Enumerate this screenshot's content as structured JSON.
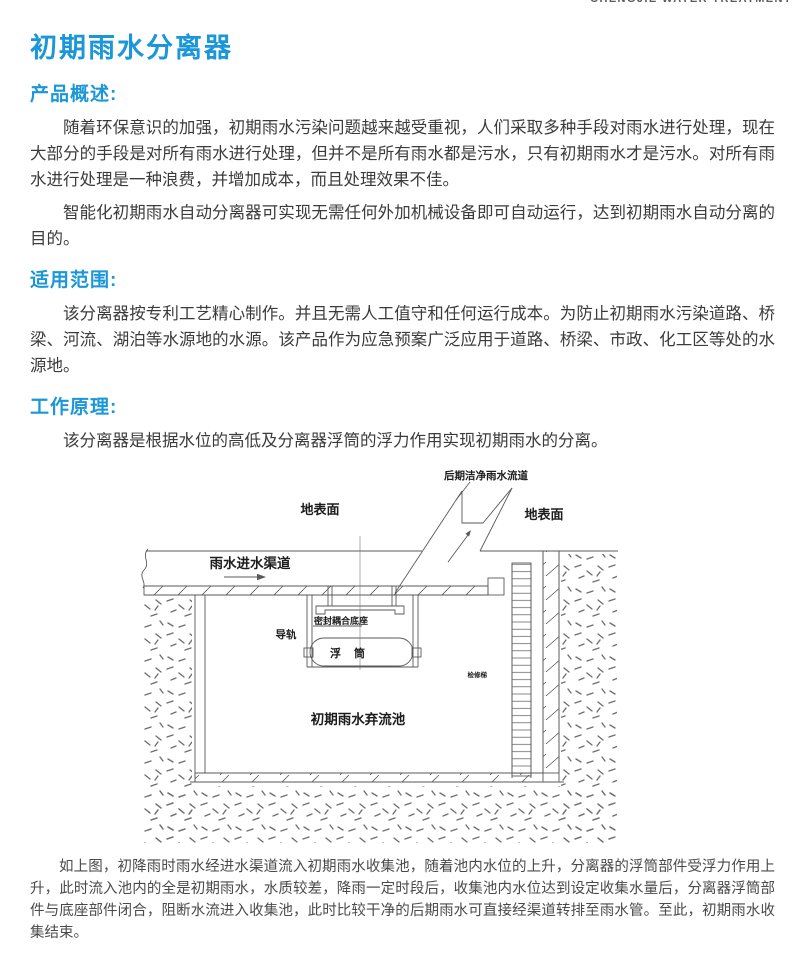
{
  "header": {
    "brand_text": "CHENGJIE WATER TREATMENT"
  },
  "page": {
    "title": "初期雨水分离器"
  },
  "sections": {
    "overview": {
      "heading": "产品概述:",
      "paragraphs": [
        "随着环保意识的加强，初期雨水污染问题越来越受重视，人们采取多种手段对雨水进行处理，现在大部分的手段是对所有雨水进行处理，但并不是所有雨水都是污水，只有初期雨水才是污水。对所有雨水进行处理是一种浪费，并增加成本，而且处理效果不佳。",
        "智能化初期雨水自动分离器可实现无需任何外加机械设备即可自动运行，达到初期雨水自动分离的目的。"
      ]
    },
    "scope": {
      "heading": "适用范围:",
      "paragraphs": [
        "该分离器按专利工艺精心制作。并且无需人工值守和任何运行成本。为防止初期雨水污染道路、桥梁、河流、湖泊等水源地的水源。该产品作为应急预案广泛应用于道路、桥梁、市政、化工区等处的水源地。"
      ]
    },
    "principle": {
      "heading": "工作原理:",
      "paragraphs": [
        "该分离器是根据水位的高低及分离器浮筒的浮力作用实现初期雨水的分离。"
      ]
    }
  },
  "diagram": {
    "labels": {
      "clean_outlet": "后期洁净雨水流道",
      "ground_left": "地表面",
      "ground_right": "地表面",
      "inlet_channel": "雨水进水渠道",
      "seal_base": "密封耦合底座",
      "guide_rail": "导轨",
      "float_drum": "浮筒",
      "tank": "初期雨水弃流池",
      "ladder": "检修梯"
    }
  },
  "footer_paragraph": "如上图，初降雨时雨水经进水渠道流入初期雨水收集池，随着池内水位的上升，分离器的浮筒部件受浮力作用上升，此时流入池内的全是初期雨水，水质较差，降雨一定时段后，收集池内水位达到设定收集水量后，分离器浮筒部件与底座部件闭合，阻断水流进入收集池，此时比较干净的后期雨水可直接经渠道转排至雨水管。至此，初期雨水收集结束。",
  "colors": {
    "accent_blue": "#1a97d8",
    "body_text": "#3b3b3b",
    "diagram_line": "#5a5a5a"
  }
}
